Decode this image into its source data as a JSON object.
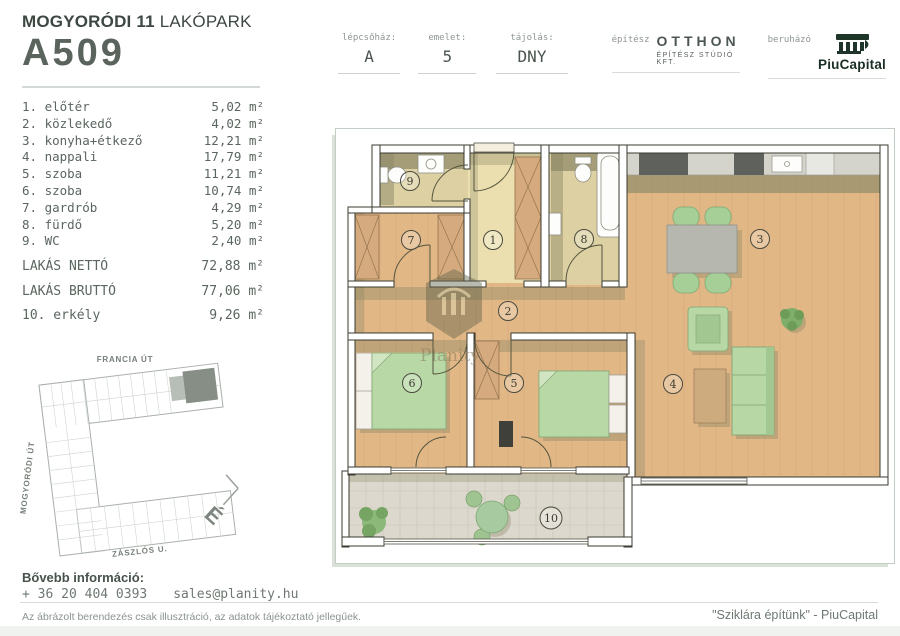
{
  "header": {
    "project_bold": "MOGYORÓDI 11",
    "project_light": " LAKÓPARK",
    "unit_id": "A509",
    "info": [
      {
        "label": "lépcsőház:",
        "value": "A"
      },
      {
        "label": "emelet:",
        "value": "5"
      },
      {
        "label": "tájolás:",
        "value": "DNY"
      }
    ],
    "architect_label": "építész",
    "architect_name": "OTTHON",
    "architect_sub": "ÉPÍTÉSZ STÚDIÓ KFT.",
    "developer_label": "beruházó",
    "developer_name": "PiuCapital"
  },
  "rooms": [
    {
      "name": "1. előtér",
      "area": "5,02 m²"
    },
    {
      "name": "2. közlekedő",
      "area": "4,02 m²"
    },
    {
      "name": "3. konyha+étkező",
      "area": "12,21 m²"
    },
    {
      "name": "4. nappali",
      "area": "17,79 m²"
    },
    {
      "name": "5. szoba",
      "area": "11,21 m²"
    },
    {
      "name": "6. szoba",
      "area": "10,74 m²"
    },
    {
      "name": "7. gardrób",
      "area": "4,29 m²"
    },
    {
      "name": "8. fürdő",
      "area": "5,20 m²"
    },
    {
      "name": "9. WC",
      "area": "2,40 m²"
    }
  ],
  "totals": [
    {
      "name": "LAKÁS NETTÓ",
      "area": "72,88 m²"
    },
    {
      "name": "LAKÁS BRUTTÓ",
      "area": "77,06 m²"
    }
  ],
  "balcony_row": {
    "name": "10. erkély",
    "area": "9,26 m²"
  },
  "site_plan": {
    "streets": {
      "top": "FRANCIA ÚT",
      "left": "MOGYORÓDI ÚT",
      "bottom": "ZÁSZLÓS U."
    },
    "compass": "É"
  },
  "plan": {
    "watermark": "Planity",
    "labels": [
      {
        "n": "1"
      },
      {
        "n": "2"
      },
      {
        "n": "3"
      },
      {
        "n": "4"
      },
      {
        "n": "5"
      },
      {
        "n": "6"
      },
      {
        "n": "7"
      },
      {
        "n": "8"
      },
      {
        "n": "9"
      },
      {
        "n": "10"
      }
    ]
  },
  "footer": {
    "info_title": "Bővebb információ:",
    "phone": "+ 36 20 404 0393",
    "email": "sales@planity.hu",
    "disclaimer": "Az ábrázolt berendezés csak illusztráció, az adatok tájékoztató jellegűek.",
    "quote": "\"Sziklára építünk\" - PiuCapital"
  },
  "colors": {
    "brand_green": "#1c2f24",
    "text_gray_green": "#5b665f",
    "wood_floor": "#e1b786",
    "furniture_green": "#b7d7a5",
    "shadow_olive": "#8b8867"
  }
}
